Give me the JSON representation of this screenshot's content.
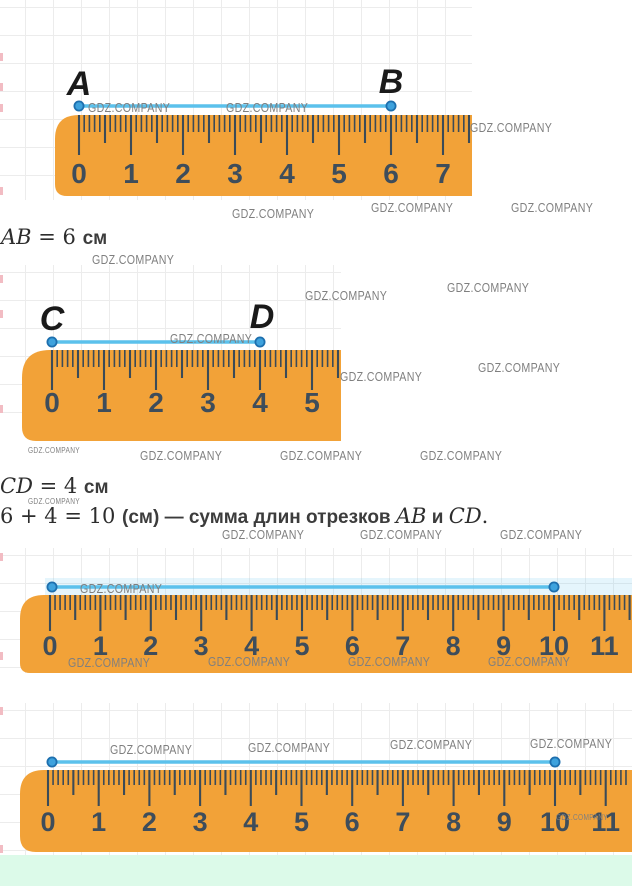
{
  "watermarks": {
    "text": "GDZ.COMPANY",
    "items": [
      {
        "x": 88,
        "y": 100,
        "s": "n"
      },
      {
        "x": 226,
        "y": 100,
        "s": "n"
      },
      {
        "x": 470,
        "y": 120,
        "s": "n"
      },
      {
        "x": 232,
        "y": 206,
        "s": "n"
      },
      {
        "x": 371,
        "y": 200,
        "s": "n"
      },
      {
        "x": 511,
        "y": 200,
        "s": "n"
      },
      {
        "x": 92,
        "y": 252,
        "s": "n"
      },
      {
        "x": 447,
        "y": 280,
        "s": "n"
      },
      {
        "x": 305,
        "y": 288,
        "s": "n"
      },
      {
        "x": 170,
        "y": 331,
        "s": "n"
      },
      {
        "x": 478,
        "y": 360,
        "s": "n"
      },
      {
        "x": 340,
        "y": 369,
        "s": "n"
      },
      {
        "x": 28,
        "y": 446,
        "s": "t"
      },
      {
        "x": 140,
        "y": 448,
        "s": "n"
      },
      {
        "x": 280,
        "y": 448,
        "s": "n"
      },
      {
        "x": 420,
        "y": 448,
        "s": "n"
      },
      {
        "x": 28,
        "y": 497,
        "s": "t"
      },
      {
        "x": 222,
        "y": 527,
        "s": "n"
      },
      {
        "x": 360,
        "y": 527,
        "s": "n"
      },
      {
        "x": 500,
        "y": 527,
        "s": "n"
      },
      {
        "x": 80,
        "y": 581,
        "s": "n"
      },
      {
        "x": 68,
        "y": 655,
        "s": "n"
      },
      {
        "x": 208,
        "y": 654,
        "s": "n"
      },
      {
        "x": 348,
        "y": 654,
        "s": "n"
      },
      {
        "x": 488,
        "y": 654,
        "s": "n"
      },
      {
        "x": 110,
        "y": 742,
        "s": "n"
      },
      {
        "x": 248,
        "y": 740,
        "s": "n"
      },
      {
        "x": 390,
        "y": 737,
        "s": "n"
      },
      {
        "x": 530,
        "y": 736,
        "s": "n"
      },
      {
        "x": 556,
        "y": 813,
        "s": "t"
      }
    ]
  },
  "texts": {
    "line_ab": [
      {
        "t": "AB",
        "s": "mi"
      },
      {
        "t": " = 6 ",
        "s": "mn"
      },
      {
        "t": "см",
        "s": "tb"
      }
    ],
    "line_cd": [
      {
        "t": "CD",
        "s": "mi"
      },
      {
        "t": " = 4 ",
        "s": "mn"
      },
      {
        "t": "см",
        "s": "tb"
      }
    ],
    "line_sum": [
      {
        "t": "6 + 4 = 10 ",
        "s": "mn"
      },
      {
        "t": "(см) — сумма длин отрезков ",
        "s": "tb"
      },
      {
        "t": "AB",
        "s": "mi"
      },
      {
        "t": " и ",
        "s": "tb"
      },
      {
        "t": "CD",
        "s": "mi"
      },
      {
        "t": ".",
        "s": "mn"
      }
    ]
  },
  "colors": {
    "ruler": "#F2A238",
    "tick": "#3B4B58",
    "number": "#3E4D5B",
    "segment": "#5BC1EC",
    "dot_fill": "#3EA2DD",
    "dot_stroke": "#1D6FAE",
    "watermark": "#7F7F7F",
    "grid": "#ECECEC",
    "label": "#1A1A1A",
    "footer": "#DCFAE9"
  },
  "figures": [
    {
      "name": "figure-ab",
      "area": {
        "x": 0,
        "y": 0,
        "w": 472,
        "h": 200
      },
      "edge_marks": [
        53,
        83,
        104,
        187
      ],
      "ruler": {
        "x1": 55,
        "x2": 472,
        "top": 115,
        "bottom": 196,
        "zero": 79,
        "step": 52,
        "max": 7,
        "num_baseline": 183,
        "num_size": 28,
        "rt": 24,
        "rb": 12,
        "tick_len": [
          40,
          28,
          17
        ]
      },
      "segment": {
        "x1": 79,
        "x2": 391,
        "y": 106
      },
      "labels": [
        {
          "t": "A",
          "x": 79,
          "b": 95
        },
        {
          "t": "B",
          "x": 391,
          "b": 93
        }
      ]
    },
    {
      "name": "figure-cd",
      "area": {
        "x": 0,
        "y": 265,
        "w": 341,
        "h": 172
      },
      "edge_marks": [
        275,
        310,
        405
      ],
      "ruler": {
        "x1": 22,
        "x2": 341,
        "top": 350,
        "bottom": 441,
        "zero": 52,
        "step": 52,
        "max": 5,
        "num_baseline": 412,
        "num_size": 28,
        "rt": 28,
        "rb": 14,
        "tick_len": [
          40,
          28,
          17
        ]
      },
      "segment": {
        "x1": 52,
        "x2": 260,
        "y": 342
      },
      "labels": [
        {
          "t": "C",
          "x": 52,
          "b": 330
        },
        {
          "t": "D",
          "x": 262,
          "b": 328
        }
      ]
    },
    {
      "name": "figure-sum-1",
      "area": {
        "x": 0,
        "y": 548,
        "w": 632,
        "h": 125
      },
      "edge_marks": [
        553,
        652
      ],
      "halo": {
        "x": 45,
        "y": 578,
        "w": 587,
        "h": 17
      },
      "ruler": {
        "x1": 20,
        "x2": 632,
        "top": 595,
        "bottom": 673,
        "zero": 50,
        "step": 50.4,
        "max": 11,
        "num_baseline": 655,
        "num_size": 27,
        "rt": 24,
        "rb": 10,
        "tick_len": [
          36,
          25,
          15
        ]
      },
      "segment": {
        "x1": 52,
        "x2": 554,
        "y": 587
      },
      "labels": []
    },
    {
      "name": "figure-sum-2",
      "area": {
        "x": 0,
        "y": 703,
        "w": 632,
        "h": 152
      },
      "edge_marks": [
        707,
        845
      ],
      "ruler": {
        "x1": 20,
        "x2": 632,
        "top": 770,
        "bottom": 852,
        "zero": 48,
        "step": 50.7,
        "max": 11,
        "num_baseline": 831,
        "num_size": 27,
        "rt": 24,
        "rb": 16,
        "tick_len": [
          36,
          25,
          15
        ]
      },
      "segment": {
        "x1": 52,
        "x2": 555,
        "y": 762
      },
      "labels": []
    }
  ]
}
